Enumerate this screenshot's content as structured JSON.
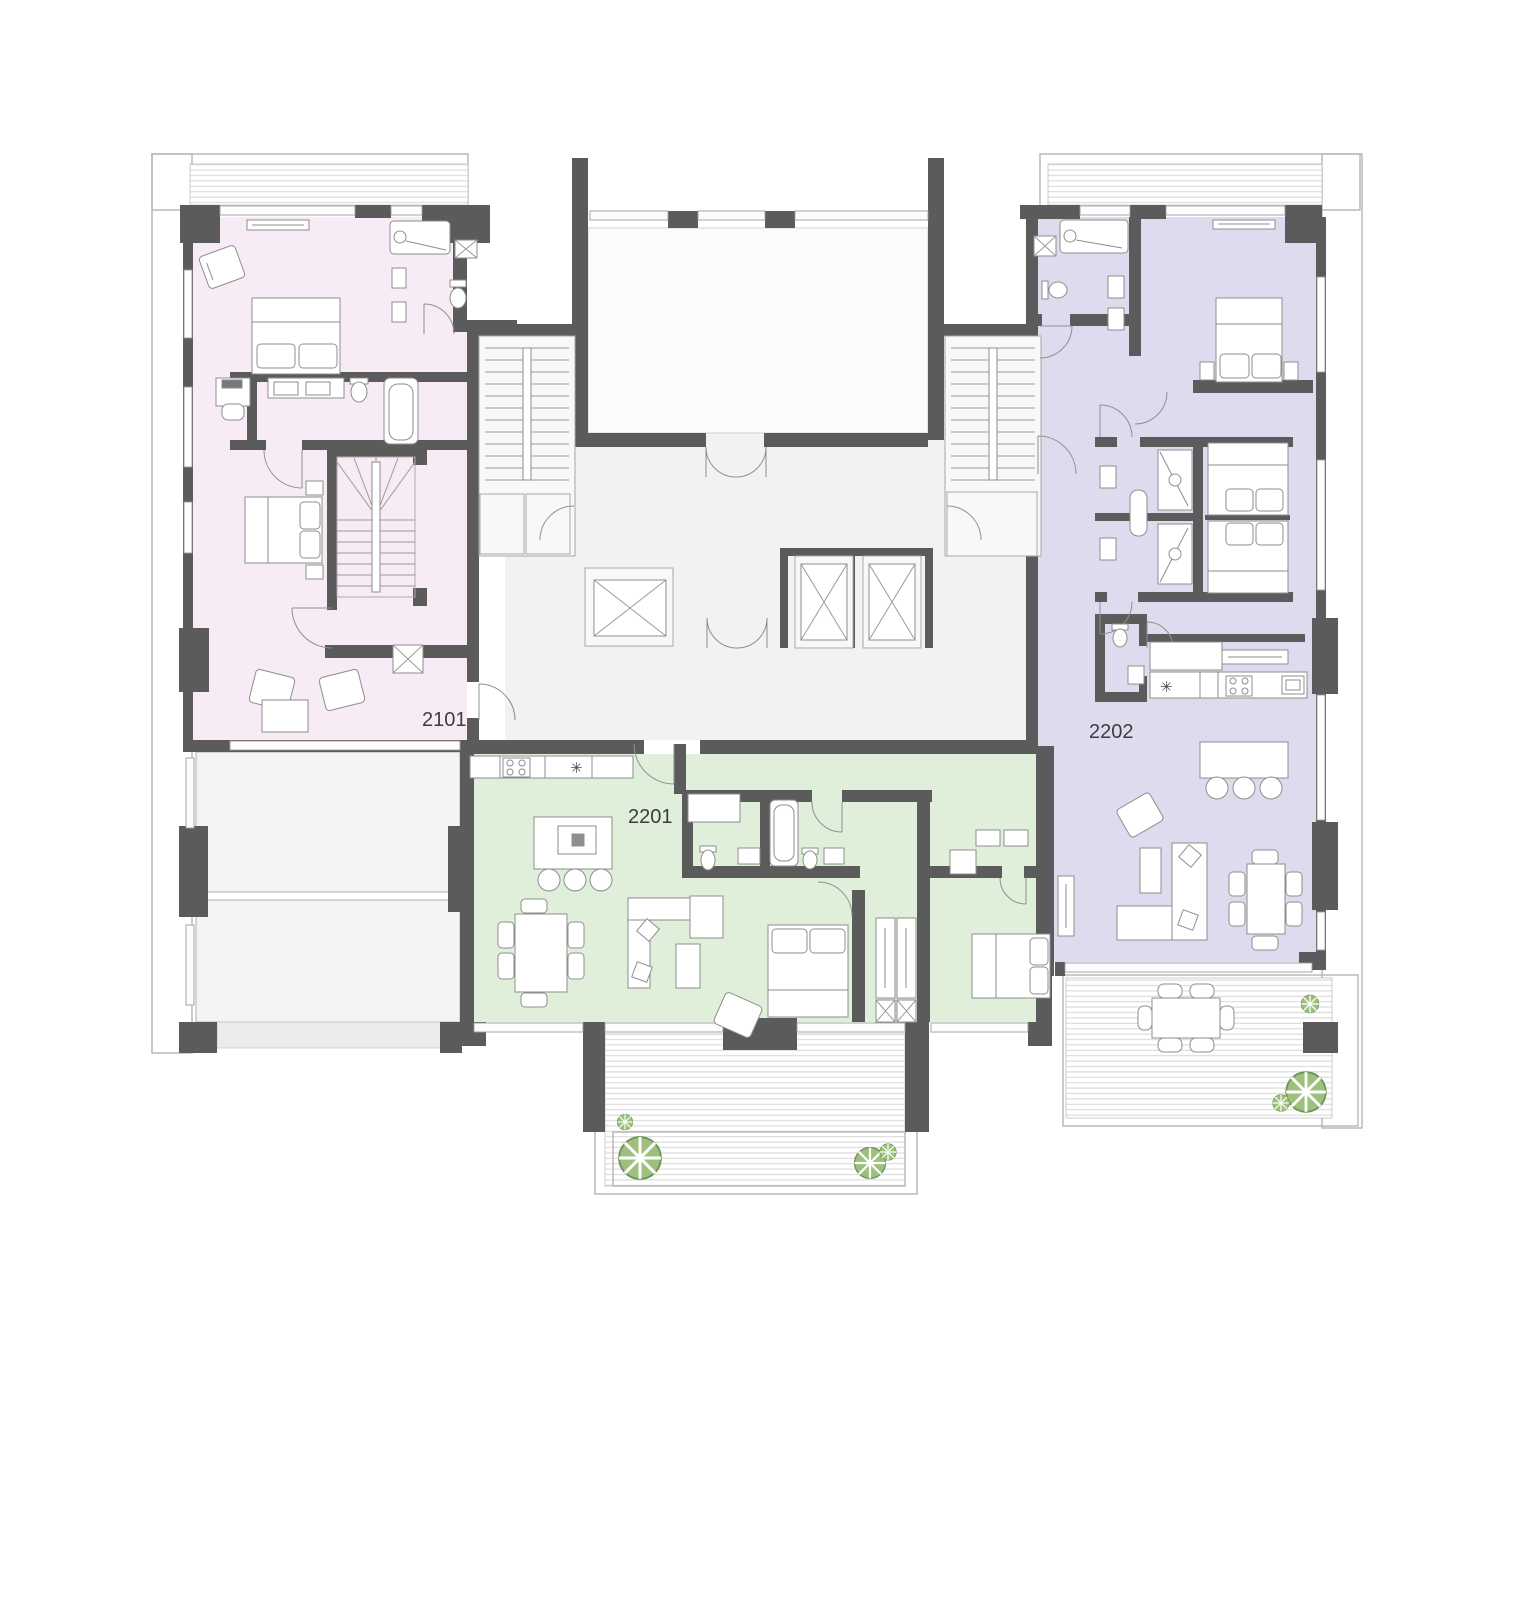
{
  "plan": {
    "type": "residential-floor-plan",
    "units": [
      {
        "id": "2101",
        "fill": "#f7ecf5"
      },
      {
        "id": "2201",
        "fill": "#e0efda"
      },
      {
        "id": "2202",
        "fill": "#dcdcee"
      }
    ],
    "colors": {
      "wall": "#5b5b5b",
      "corridor": "#f2f2f2",
      "void_room": "#fbfbfb",
      "terrace_line": "#b5b5b5",
      "deck_stripe": "#d6d6d6",
      "plant_fill": "#9dc07d",
      "plant_line": "#71935a",
      "label_text": "#3d3d3d"
    },
    "icons": {
      "appliance": "✳"
    }
  }
}
